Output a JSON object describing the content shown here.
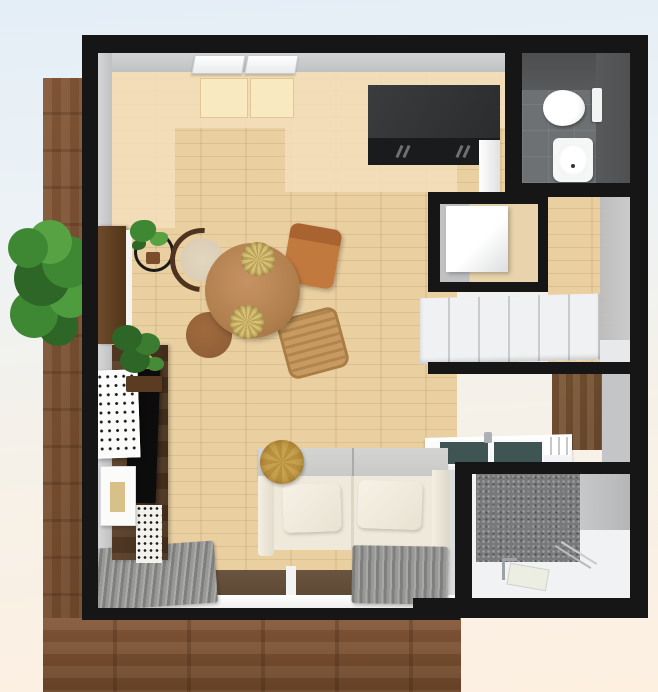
{
  "scene": {
    "title": "3D top-down floor plan of a studio apartment",
    "view": "overhead 3D render, no visible text"
  },
  "colors": {
    "bg_top": "#e4eef6",
    "bg_bottom": "#fdf0e1",
    "balcony_wood": "#86593a",
    "balcony_wood_dark": "#6b4527",
    "wall_black": "#161616",
    "wall_gray": "#bfc1c3",
    "floor_wood": "#ead0a1",
    "floor_pale": "#f2debb",
    "mat_cream": "#f8e9c0",
    "kitchen_black": "#2a2c2d",
    "kitchen_face": "#1a1b1c",
    "bath_wall": "#57595b",
    "bath_floor": "#6e7173",
    "closet_white": "#f0f1f2",
    "counter_white": "#edeff0",
    "burner_teal": "#3f5553",
    "wardrobe_wood": "#6f4c2e",
    "entry_tile": "#77797b",
    "entry_floor": "#f1f2f3",
    "sofa_back": "#c8c8c6",
    "sofa_seat": "#efe9db",
    "cushion_gold": "#c7a14e",
    "rug_gray": "#989997",
    "rug_dark": "#7f807e",
    "deck_dark": "#5c4833",
    "table_wood": "#b1804e",
    "chair_orange": "#c2793e",
    "chair_beige": "#d8cab2",
    "stool_brown": "#8c5b35",
    "rattan": "#c89a62",
    "plant_green": "#3f8833",
    "plant_dark": "#2d6626",
    "tv_black": "#0c0c0d",
    "cabinet_wood": "#4a3220",
    "frame_white": "#fbfbfa"
  },
  "rooms": [
    {
      "name": "living-room",
      "label": "Living / dining room with wood floor"
    },
    {
      "name": "toilet-room",
      "label": "Toilet room with dark tiles, toilet and washbasin"
    },
    {
      "name": "washer-nook",
      "label": "Washer nook with washing machine"
    },
    {
      "name": "hallway",
      "label": "Hallway with wood floor"
    },
    {
      "name": "closet",
      "label": "Closet with white sliding doors"
    },
    {
      "name": "kitchenette",
      "label": "Kitchenette counter with two burners and faucet"
    },
    {
      "name": "shower-room",
      "label": "Shower / entry room with gray tile wall and white floor"
    },
    {
      "name": "balcony",
      "label": "Wood balcony deck along left and bottom"
    }
  ],
  "furniture": [
    {
      "name": "kitchen-unit",
      "label": "Black kitchen cabinet unit"
    },
    {
      "name": "dining-table",
      "label": "Round wood dining table with two woven plates"
    },
    {
      "name": "wishbone-chair",
      "label": "Chair with curved dark back and beige seat"
    },
    {
      "name": "orange-chair",
      "label": "Orange wooden chair"
    },
    {
      "name": "stool",
      "label": "Round brown stool"
    },
    {
      "name": "rattan-chair",
      "label": "Woven rattan chair"
    },
    {
      "name": "sofa",
      "label": "Two-seat sofa, gray back and cream cushions"
    },
    {
      "name": "gold-cushion",
      "label": "Round gold cushion on sofa arm"
    },
    {
      "name": "tv-cabinet",
      "label": "Dark walnut TV cabinet with flat TV"
    },
    {
      "name": "lattice-panel",
      "label": "White perforated lattice panel"
    },
    {
      "name": "picture-frame",
      "label": "Framed picture leaning on wall"
    },
    {
      "name": "washing-machine",
      "label": "White washing machine"
    },
    {
      "name": "toilet",
      "label": "White toilet"
    },
    {
      "name": "washbasin",
      "label": "White washbasin"
    },
    {
      "name": "wardrobe",
      "label": "Brown wood wardrobe"
    },
    {
      "name": "plants",
      "label": "Green potted plants"
    },
    {
      "name": "rugs",
      "label": "Gray shaggy rugs and throw"
    },
    {
      "name": "windows",
      "label": "White wall windows and balcony glass doors"
    }
  ]
}
